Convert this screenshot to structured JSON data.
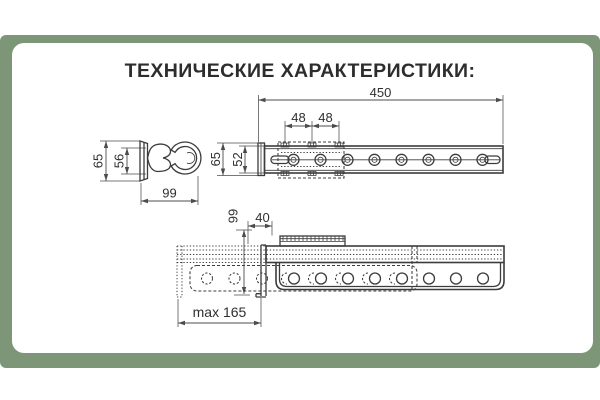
{
  "title": "ТЕХНИЧЕСКИЕ ХАРАКТЕРИСТИКИ:",
  "colors": {
    "frame_green": "#7d9678",
    "line_dark": "#3c3c3c",
    "text_dark": "#2d2d2d"
  },
  "views": {
    "cross_section": {
      "outer_height": "65",
      "inner_height": "56",
      "width": "99"
    },
    "side_view": {
      "total_length": "450",
      "hole_pitch_a": "48",
      "hole_pitch_b": "48",
      "outer_height": "65",
      "inner_height": "52"
    },
    "extended_view": {
      "mount_depth": "99",
      "front_offset": "40",
      "max_extension": "max 165"
    }
  }
}
